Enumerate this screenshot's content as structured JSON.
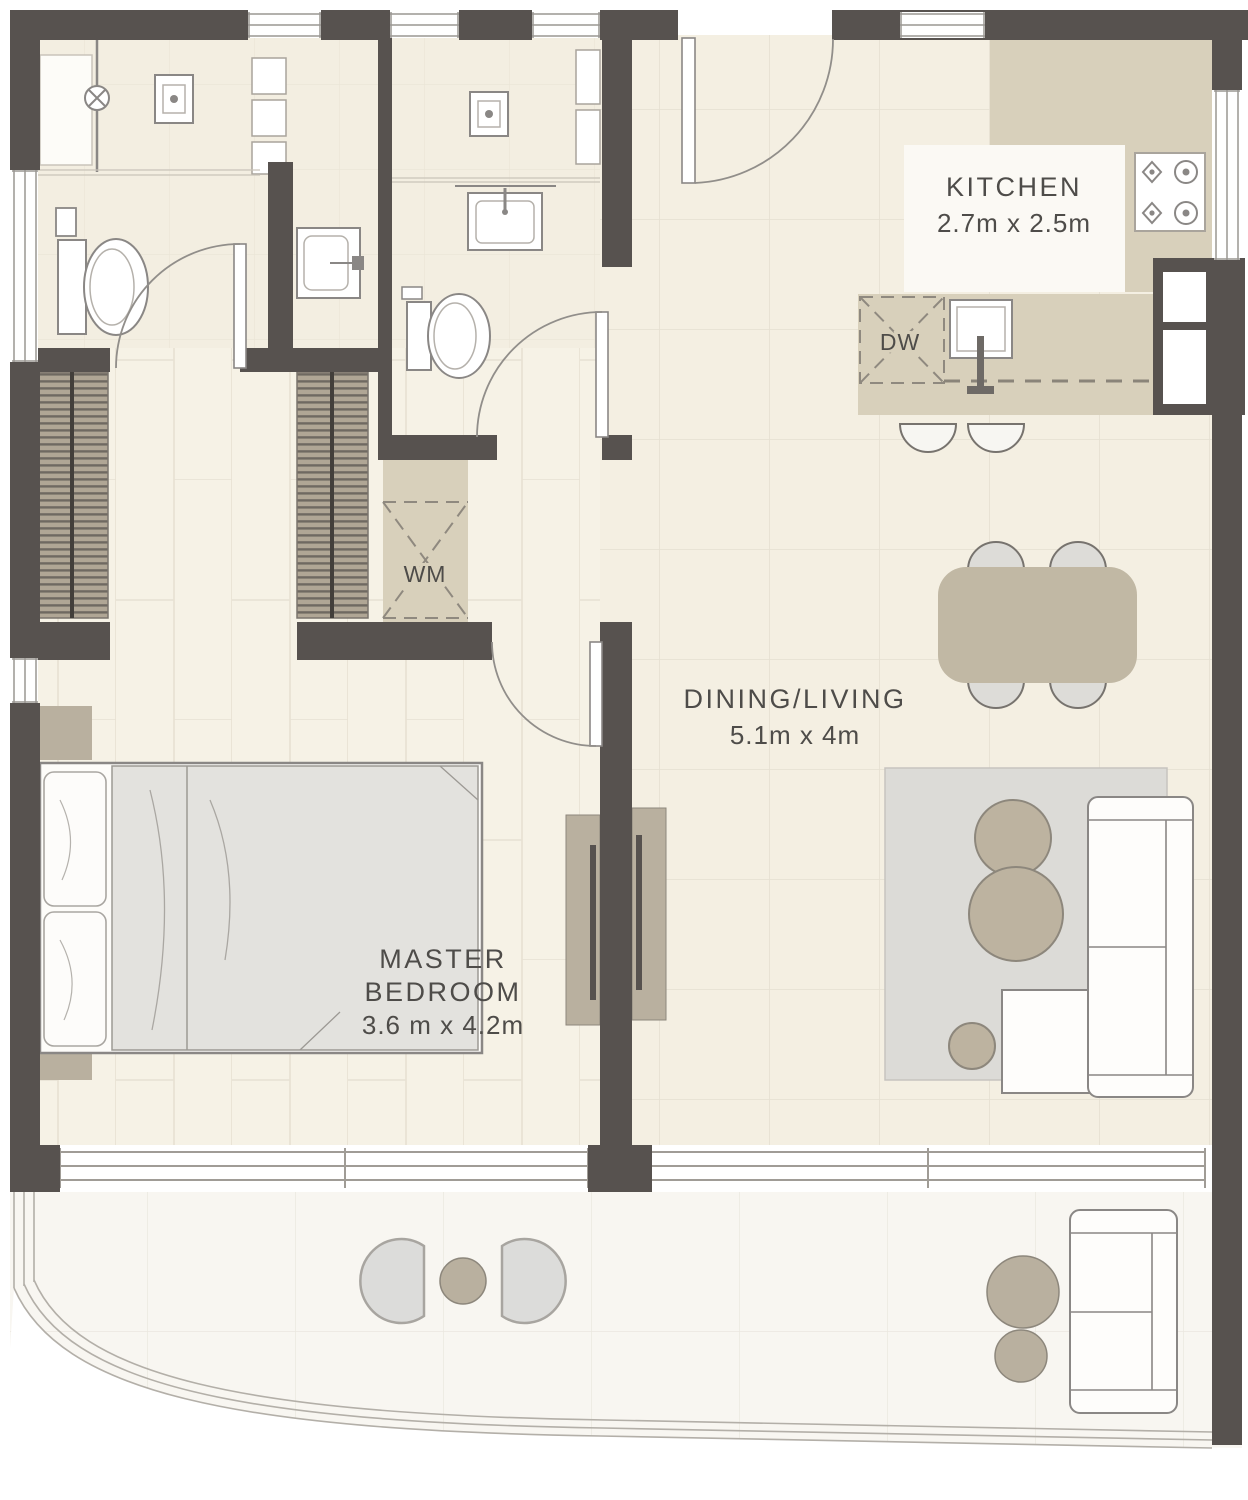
{
  "plan": {
    "type": "apartment-floor-plan",
    "rooms": {
      "kitchen": {
        "title": "KITCHEN",
        "dims": "2.7m x 2.5m"
      },
      "dining_living": {
        "title": "DINING/LIVING",
        "dims": "5.1m x 4m"
      },
      "master_bedroom": {
        "title_line1": "MASTER",
        "title_line2": "BEDROOM",
        "dims": "3.6 m x 4.2m"
      }
    },
    "appliances": {
      "dishwasher": "DW",
      "washing_machine": "WM"
    },
    "colors": {
      "wall": "#57524f",
      "floor_cream": "#f4efe2",
      "floor_bath": "#f3eee1",
      "floor_balcony": "#f8f6f1",
      "counter_tan": "#d8d0bb",
      "furniture_tan": "#c1b8a4",
      "table_tan": "#bdb3a0",
      "rug_gray": "#dcdbd7",
      "chair_gray": "#dddcd8",
      "outline": "#8a8785",
      "text": "#4e4c49"
    }
  }
}
